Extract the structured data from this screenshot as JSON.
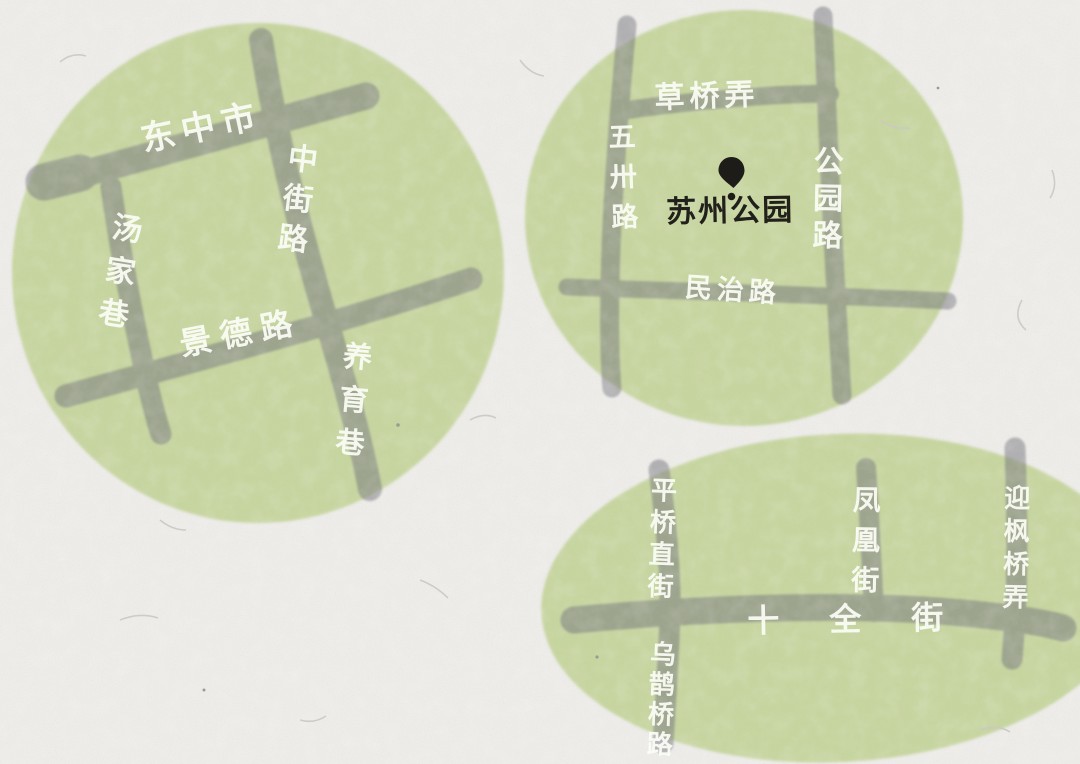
{
  "colors": {
    "paper": "#edece9",
    "green_area": "#c7d5a0",
    "road_gray": "#75757d",
    "street_label": "#fafcf4",
    "ink": "#21201b"
  },
  "areas": [
    {
      "streets": [
        {
          "label": "东中市",
          "orientation": "horizontal"
        },
        {
          "label": "中街路",
          "orientation": "vertical"
        },
        {
          "label": "汤家巷",
          "orientation": "vertical"
        },
        {
          "label": "景德路",
          "orientation": "horizontal"
        },
        {
          "label": "养育巷",
          "orientation": "vertical"
        }
      ]
    },
    {
      "streets": [
        {
          "label": "草桥弄",
          "orientation": "horizontal"
        },
        {
          "label": "五卅路",
          "orientation": "vertical"
        },
        {
          "label": "公园路",
          "orientation": "vertical"
        },
        {
          "label": "民治路",
          "orientation": "horizontal"
        }
      ],
      "poi": {
        "icon": "location-pin-icon",
        "label": "苏州公园"
      }
    },
    {
      "streets": [
        {
          "label": "平桥直街",
          "orientation": "vertical"
        },
        {
          "label": "乌鹊桥路",
          "orientation": "vertical"
        },
        {
          "label": "凤凰街",
          "orientation": "vertical"
        },
        {
          "label": "迎枫桥弄",
          "orientation": "vertical"
        },
        {
          "label": "十全街",
          "orientation": "horizontal"
        }
      ]
    }
  ]
}
